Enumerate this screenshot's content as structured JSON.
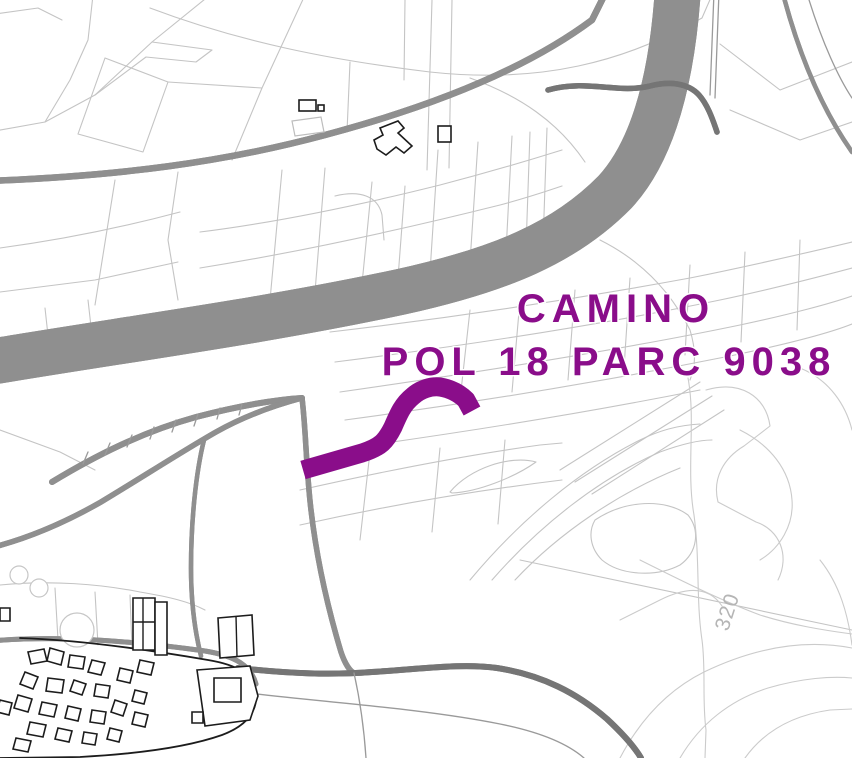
{
  "map": {
    "background": "#ffffff",
    "highlight": {
      "label_line1": "CAMINO",
      "label_line2": "POL 18 PARC 9038",
      "color": "#8A0D8A"
    },
    "contour_label": {
      "text": "320",
      "color": "#b5b5b5"
    },
    "colors": {
      "parcel_line": "#c4c4c4",
      "contour_line": "#cbcbcb",
      "road_line": "#8f8f8f",
      "road_dark": "#757575",
      "building_outline": "#1c1c1c"
    }
  }
}
